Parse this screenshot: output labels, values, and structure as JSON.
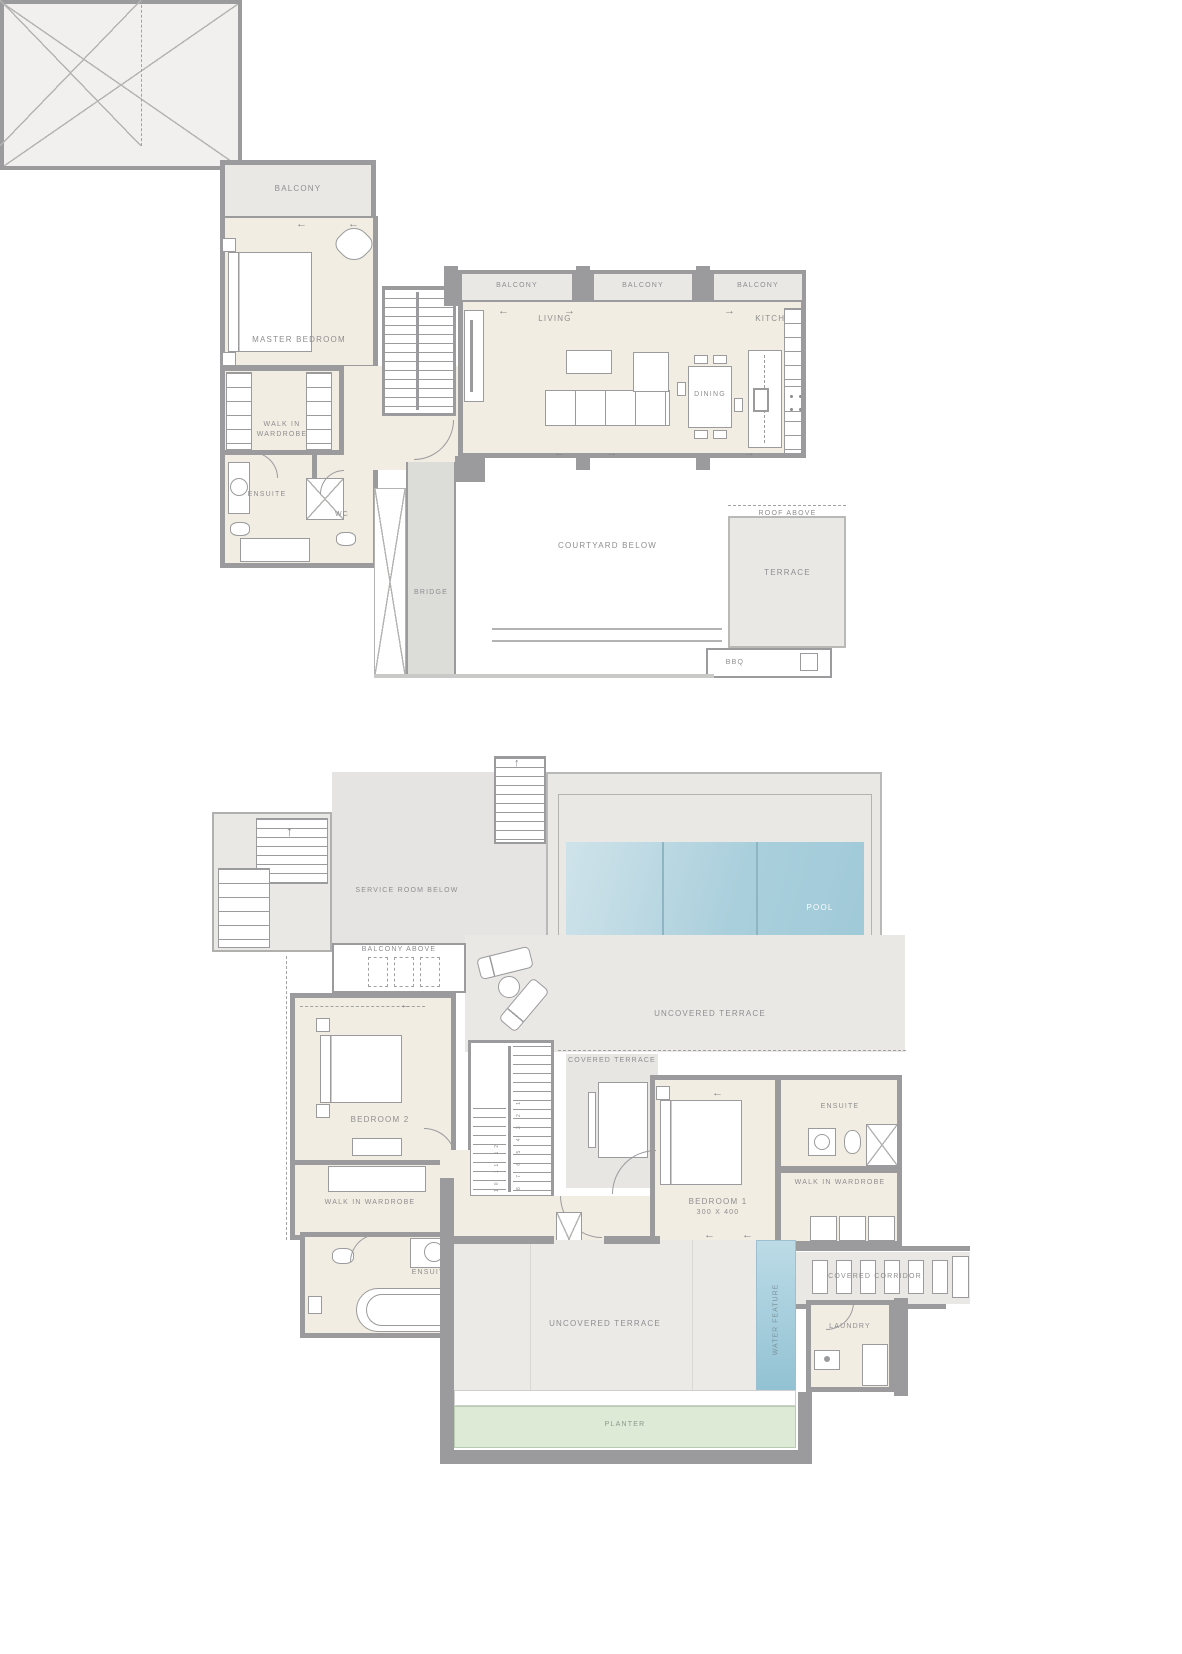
{
  "page": {
    "title": "AMALTHIA"
  },
  "icons": {
    "arrow_left": "←",
    "arrow_right": "→",
    "arrow_up": "↑"
  },
  "colors": {
    "wall": "#9b9b9e",
    "room_fill": "#f2ede2",
    "deck_fill": "#e9e8e5",
    "pool": "#a9cfdc",
    "water_feature": "#8fc0d2",
    "planter": "#dcead6",
    "label": "#8e8e90",
    "pool_ladder": "#7677b3"
  },
  "floor_upper": {
    "balcony_master": "BALCONY",
    "master_bedroom": "MASTER BEDROOM",
    "walk_in_wardrobe": "WALK IN WARDROBE",
    "ensuite": "ENSUITE",
    "wc": "WC",
    "balconies": [
      "BALCONY",
      "BALCONY",
      "BALCONY"
    ],
    "living": "LIVING",
    "dining": "DINING",
    "kitchen": "KITCHEN",
    "bridge": "BRIDGE",
    "courtyard_below": "COURTYARD BELOW",
    "roof_above": "ROOF ABOVE",
    "terrace": "TERRACE",
    "bbq": "BBQ"
  },
  "floor_lower": {
    "service_room_below": "SERVICE ROOM BELOW",
    "balcony_above": "BALCONY ABOVE",
    "pool": "POOL",
    "uncovered_terrace_top": "UNCOVERED TERRACE",
    "covered_terrace": "COVERED TERRACE",
    "bedroom2": "BEDROOM 2",
    "walk_in_wardrobe2": "WALK IN WARDROBE",
    "ensuite2": "ENSUITE",
    "bedroom1": "BEDROOM 1",
    "bedroom1_dim": "300 x 400",
    "ensuite1": "ENSUITE",
    "walk_in_wardrobe1": "WALK IN WARDROBE",
    "covered_corridor": "COVERED CORRIDOR",
    "laundry": "LAUNDRY",
    "water_feature": "WATER FEATURE",
    "uncovered_terrace_bottom": "UNCOVERED TERRACE",
    "planter": "PLANTER",
    "stair_numbers_left": "10 11 12",
    "stair_numbers_right": "8 7 6 5 4 3 2 1"
  }
}
